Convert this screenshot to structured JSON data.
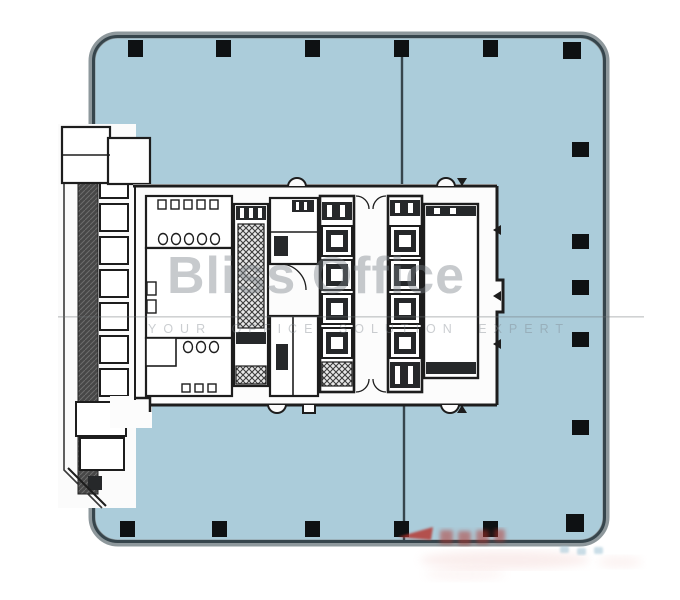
{
  "watermark": {
    "title": "Bliss Office",
    "tagline": "YOUR OFFICE SOLUTION EXPERT"
  },
  "stamp": {
    "color": "#b5312c"
  },
  "palette": {
    "page_bg": "#ffffff",
    "floor_fill": "#abccda",
    "perimeter_outer": "#8e989c",
    "perimeter_inner": "#36454c",
    "wall": "#1d1d1d",
    "column": "#0e1113",
    "core_fill": "#fcfcfc",
    "watermark_gray": "#7d8389",
    "fold_line": "#6e7376"
  },
  "plan": {
    "columns_top": 6,
    "columns_bottom": 6,
    "columns_right": 6,
    "elevator_banks": 2,
    "elevators_per_bank": 4,
    "left_strip_cells": 8
  }
}
